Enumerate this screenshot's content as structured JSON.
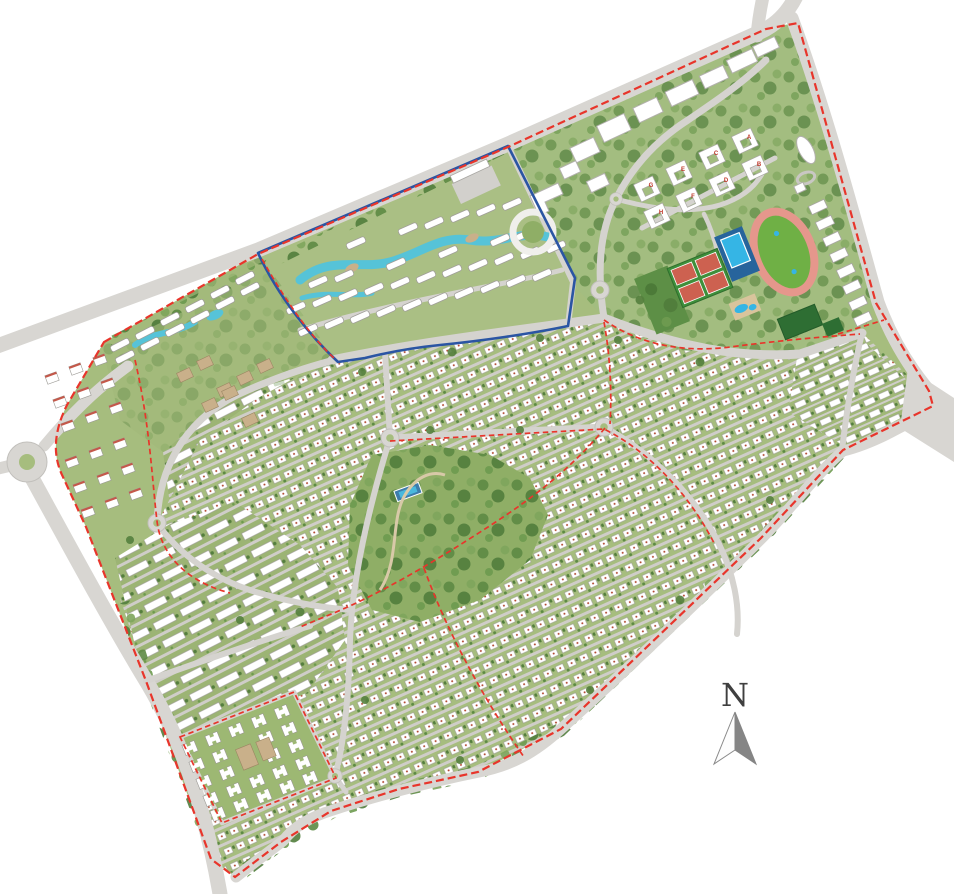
{
  "map": {
    "description": "aerial-master-plan-of-residential-community",
    "compass": {
      "label": "N"
    },
    "unit_labels": [
      "A",
      "B",
      "C",
      "D",
      "E",
      "F",
      "G",
      "H"
    ],
    "colors": {
      "background": "#ffffff",
      "site_green": "#a6bd7e",
      "tree_green": "#557f3e",
      "road_gray": "#d8d6d2",
      "boundary_red": "#e8352b",
      "district_blue": "#2b55a3",
      "water_aqua": "#35b5e5",
      "lazy_river_aqua": "#56c3d8",
      "track_pink": "#e5978c",
      "court_red": "#cd6150",
      "pitch_dark_green": "#2e6e33",
      "building_white": "#ffffff",
      "sand_tan": "#c9b08a",
      "compass_gray": "#858585"
    }
  }
}
